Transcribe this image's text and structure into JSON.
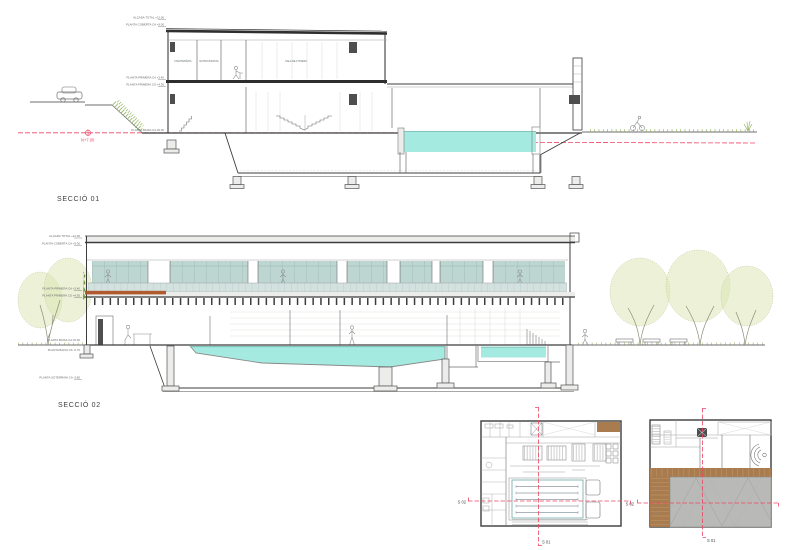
{
  "titles": {
    "s1": "SECCIÓ 01",
    "s2": "SECCIÓ 02"
  },
  "datum": {
    "label": "N+7.00"
  },
  "levels_s1": {
    "l1": "ALÇADA TOTAL +12.00",
    "l2": "PLANTA COBERTA CA +9.00",
    "l3": "PLANTA PRIMERA CA +3.40",
    "l4": "PLANTA PRIMERA CS +4.30",
    "l5": "PLANTA BAIXA CA ±0.00"
  },
  "levels_s2": {
    "l1": "ALÇADA TOTAL +12.00",
    "l2": "PLANTA COBERTA CA +9.00",
    "l3": "PLANTA PRIMERA CA +3.40",
    "l4": "PLANTA PRIMERA CS +4.30",
    "l5": "PLANTA BAIXA CA ±0.00",
    "l6": "PLANTA BAIXA CS -0.70",
    "l7": "PLANTA SOTERRANI CA -3.80"
  },
  "rooms_s1": {
    "r1": "FISIOTERÀPIA",
    "r2": "NUTRICIONISTA",
    "r3": "SALA DE FITNESS"
  },
  "markers": {
    "s01": "S 01",
    "s02": "S 02"
  },
  "colors": {
    "water": "#a5eae1",
    "glass": "#bed6d2",
    "glass2": "#d4e2df",
    "tree": "#dce6b6",
    "treeline": "#aebf85",
    "deckA": "#b05a30",
    "deckB": "#a97c4f",
    "roof": "#b9b9b7",
    "marker": "#ee4666",
    "plant": "#6f9440",
    "grass": "#9ab86a"
  }
}
